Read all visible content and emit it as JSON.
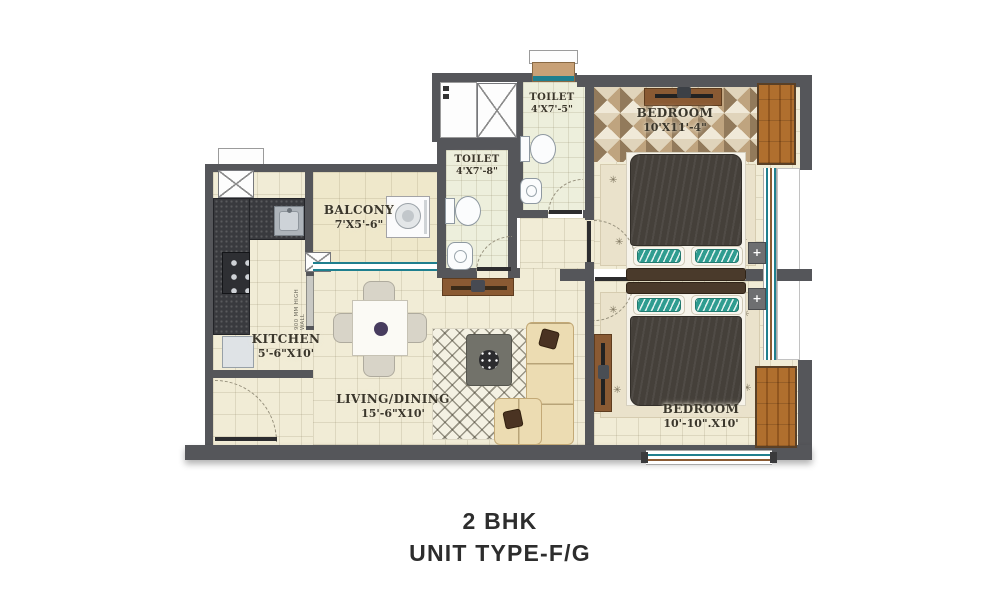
{
  "title": {
    "line1": "2 BHK",
    "line2": "UNIT TYPE-F/G"
  },
  "rooms": {
    "balcony": {
      "name": "BALCONY",
      "dims": "7'X5'-6\""
    },
    "toilet_top": {
      "name": "TOILET",
      "dims": "4'X7'-5\""
    },
    "toilet_mid": {
      "name": "TOILET",
      "dims": "4'X7'-8\""
    },
    "bedroom_top": {
      "name": "BEDROOM",
      "dims": "10'X11'-4\""
    },
    "kitchen": {
      "name": "KITCHEN",
      "dims": "5'-6\"X10'"
    },
    "living_dining": {
      "name": "LIVING/DINING",
      "dims": "15'-6\"X10'"
    },
    "bedroom_bottom": {
      "name": "BEDROOM",
      "dims": "10'-10\".X10'"
    }
  },
  "annotations": {
    "half_wall_note": "900 MM HIGH WALL"
  },
  "glyphs": {
    "rug_motif": "✳",
    "side_table_plus": "+"
  },
  "colors": {
    "wall": "#55565a",
    "floor": "#f1ecd6",
    "wood": "#ab6b2e",
    "window_teal": "#1f7f8e",
    "cushion_teal": "#2f9c90",
    "title_text": "#2d2d2d"
  }
}
